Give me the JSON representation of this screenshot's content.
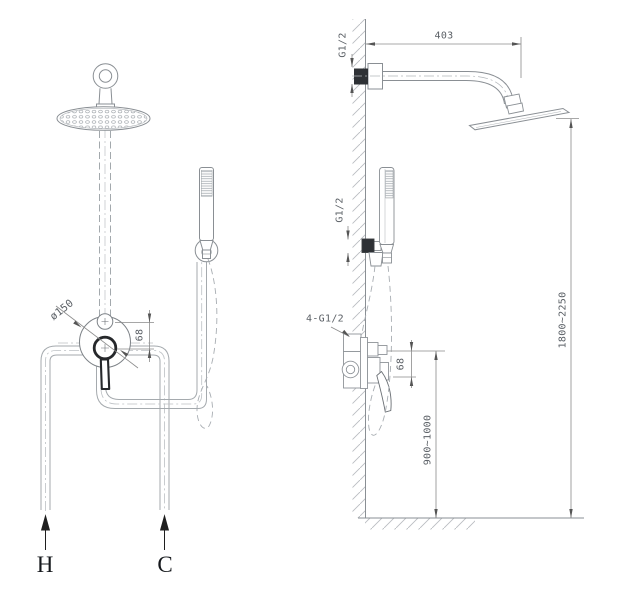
{
  "front_view": {
    "head_diameter": "ø150",
    "port_offset": "68",
    "hot_supply": "H",
    "cold_supply": "C"
  },
  "side_view": {
    "arm_length": "403",
    "arm_thread": "G1/2",
    "holder_thread": "G1/2",
    "valve_thread": "4-G1/2",
    "port_offset": "68",
    "mixer_height_range": "900~1000",
    "head_height_range": "1800~2250"
  },
  "colors": {
    "background": "#ffffff",
    "outline": "#8a8f94",
    "dark_outline": "#26282b",
    "dimension_text": "#5b6066",
    "black_fitting": "#2e3135"
  }
}
